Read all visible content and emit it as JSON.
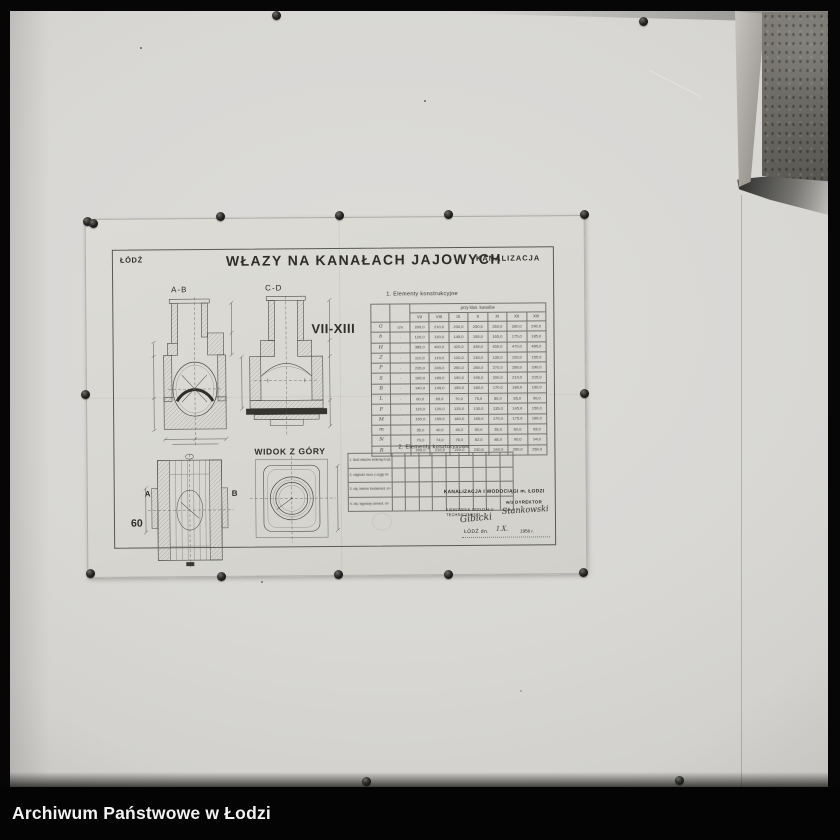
{
  "archive_bar": {
    "label": "Archiwum Państwowe w Łodzi"
  },
  "sheet": {
    "city": "ŁÓDŹ",
    "title": "WŁAZY NA KANAŁACH JAJOWYCH",
    "department": "KANALIZACJA",
    "section_ab_label": "A-B",
    "section_cd_label": "C-D",
    "range_label": "VII-XIII",
    "top_view_label": "WIDOK Z GÓRY",
    "plan_label_a": "A",
    "plan_label_b": "B",
    "sheet_number": "60",
    "table1": {
      "title": "1. Elementy konstrukcyjne",
      "span_header": "przy klas. kanałów",
      "columns": [
        "VII",
        "VIII",
        "IX",
        "X",
        "XI",
        "XII",
        "XIII"
      ],
      "rows": [
        {
          "label": "G",
          "unit": "cm",
          "values": [
            "200,0",
            "210,0",
            "230,0",
            "250,0",
            "260,0",
            "280,0",
            "290,0"
          ]
        },
        {
          "label": "b",
          "unit": "·",
          "values": [
            "120,0",
            "130,0",
            "145,0",
            "155,0",
            "165,0",
            "175,0",
            "185,0"
          ]
        },
        {
          "label": "H",
          "unit": "·",
          "values": [
            "385,0",
            "400,0",
            "420,0",
            "435,0",
            "455,0",
            "470,0",
            "485,0"
          ]
        },
        {
          "label": "Z",
          "unit": "·",
          "values": [
            "110,0",
            "115,0",
            "120,0",
            "130,0",
            "135,0",
            "150,0",
            "155,0"
          ]
        },
        {
          "label": "P",
          "unit": "·",
          "values": [
            "235,0",
            "245,0",
            "250,0",
            "260,0",
            "270,0",
            "280,0",
            "290,0"
          ]
        },
        {
          "label": "S",
          "unit": "·",
          "values": [
            "180,0",
            "185,0",
            "190,0",
            "195,0",
            "200,0",
            "210,0",
            "215,0"
          ]
        },
        {
          "label": "B",
          "unit": "·",
          "values": [
            "140,0",
            "145,0",
            "155,0",
            "160,0",
            "170,0",
            "180,0",
            "190,0"
          ]
        },
        {
          "label": "L",
          "unit": "·",
          "values": [
            "60,0",
            "65,0",
            "70,0",
            "75,0",
            "80,0",
            "85,0",
            "90,0"
          ]
        },
        {
          "label": "F",
          "unit": "·",
          "values": [
            "115,0",
            "120,0",
            "125,0",
            "130,0",
            "135,0",
            "145,0",
            "150,0"
          ]
        },
        {
          "label": "M",
          "unit": "·",
          "values": [
            "150,0",
            "155,0",
            "160,0",
            "165,0",
            "170,0",
            "175,0",
            "180,0"
          ]
        },
        {
          "label": "m",
          "unit": "·",
          "values": [
            "35,0",
            "40,0",
            "45,0",
            "50,0",
            "55,0",
            "60,0",
            "65,0"
          ]
        },
        {
          "label": "N",
          "unit": "·",
          "values": [
            "70,0",
            "74,0",
            "78,0",
            "82,0",
            "86,0",
            "90,0",
            "94,0"
          ]
        },
        {
          "label": "R",
          "unit": "·",
          "values": [
            "200,0",
            "210,0",
            "220,0",
            "230,0",
            "240,0",
            "250,0",
            "260,0"
          ]
        }
      ]
    },
    "table2": {
      "title": "2. Elementy kosztorysowe",
      "row_labels": [
        "1. ilość włazów żeliwnych szt.",
        "2. objętość muru z cegły m³",
        "3. obj. betonu fundament. m³",
        "4. obj. wyprawy cement. m²"
      ],
      "data_columns": 9
    },
    "signature_block": {
      "org": "KANALIZACJA I WODOCIĄGI m. ŁODZI",
      "director_label": "w/z DYREKTOR",
      "manager_label_1": "KIEROWNIK ODDZIAŁU",
      "manager_label_2": "TECHNICZNEGO",
      "signature_manager": "Gibicki",
      "signature_director": "Stankowski",
      "date_prefix": "ŁÓDŹ dn.",
      "date_hand": "1.X.",
      "date_year": "1956 r."
    }
  },
  "icons": {
    "pin": "push-pin",
    "count": 17
  },
  "colors": {
    "wall": "#d8d7d4",
    "paper": "#d9d8d3",
    "ink": "#2e2d29",
    "photo_border": "#060606",
    "bar_text": "#f2f2f2"
  }
}
